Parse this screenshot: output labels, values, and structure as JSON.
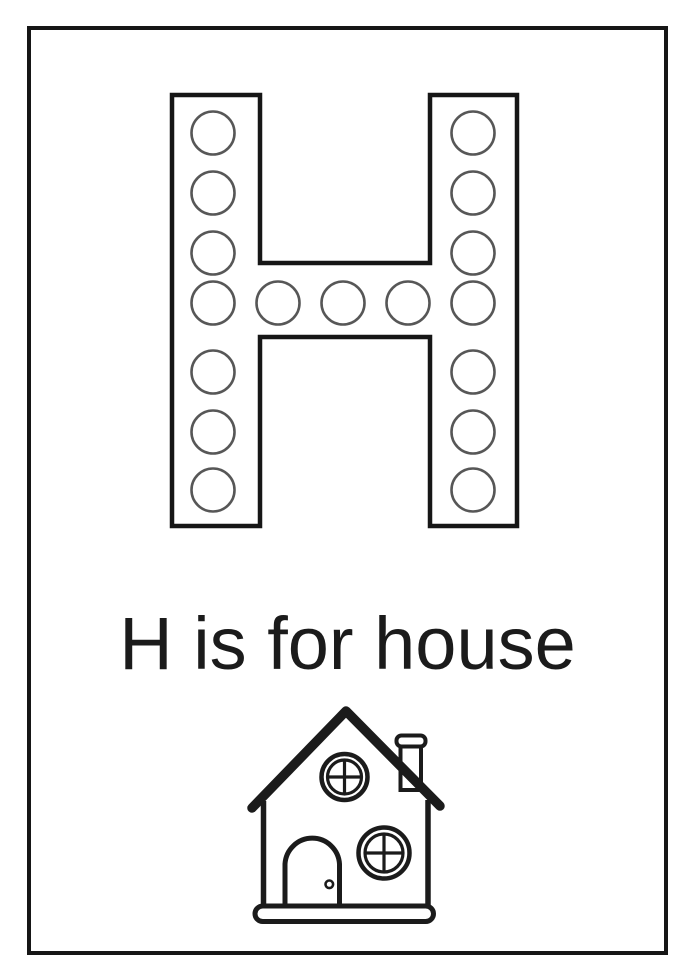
{
  "page": {
    "background_color": "#ffffff",
    "frame_color": "#161616",
    "ink_color": "#1b1b1b",
    "dot_outline_color": "#575757"
  },
  "worksheet": {
    "letter": "H",
    "caption": "H is for house",
    "word": "house",
    "illustration": "house-line-art"
  },
  "letter_dots": {
    "total": 17,
    "radius": 21.5,
    "left_column": {
      "cx": 213,
      "cys": [
        133,
        193,
        253,
        303,
        372,
        432,
        490
      ]
    },
    "right_column": {
      "cx": 473,
      "cys": [
        133,
        193,
        253,
        303,
        372,
        432,
        490
      ]
    },
    "middle_row": {
      "cy": 303,
      "cxs": [
        278,
        343,
        408
      ]
    }
  }
}
